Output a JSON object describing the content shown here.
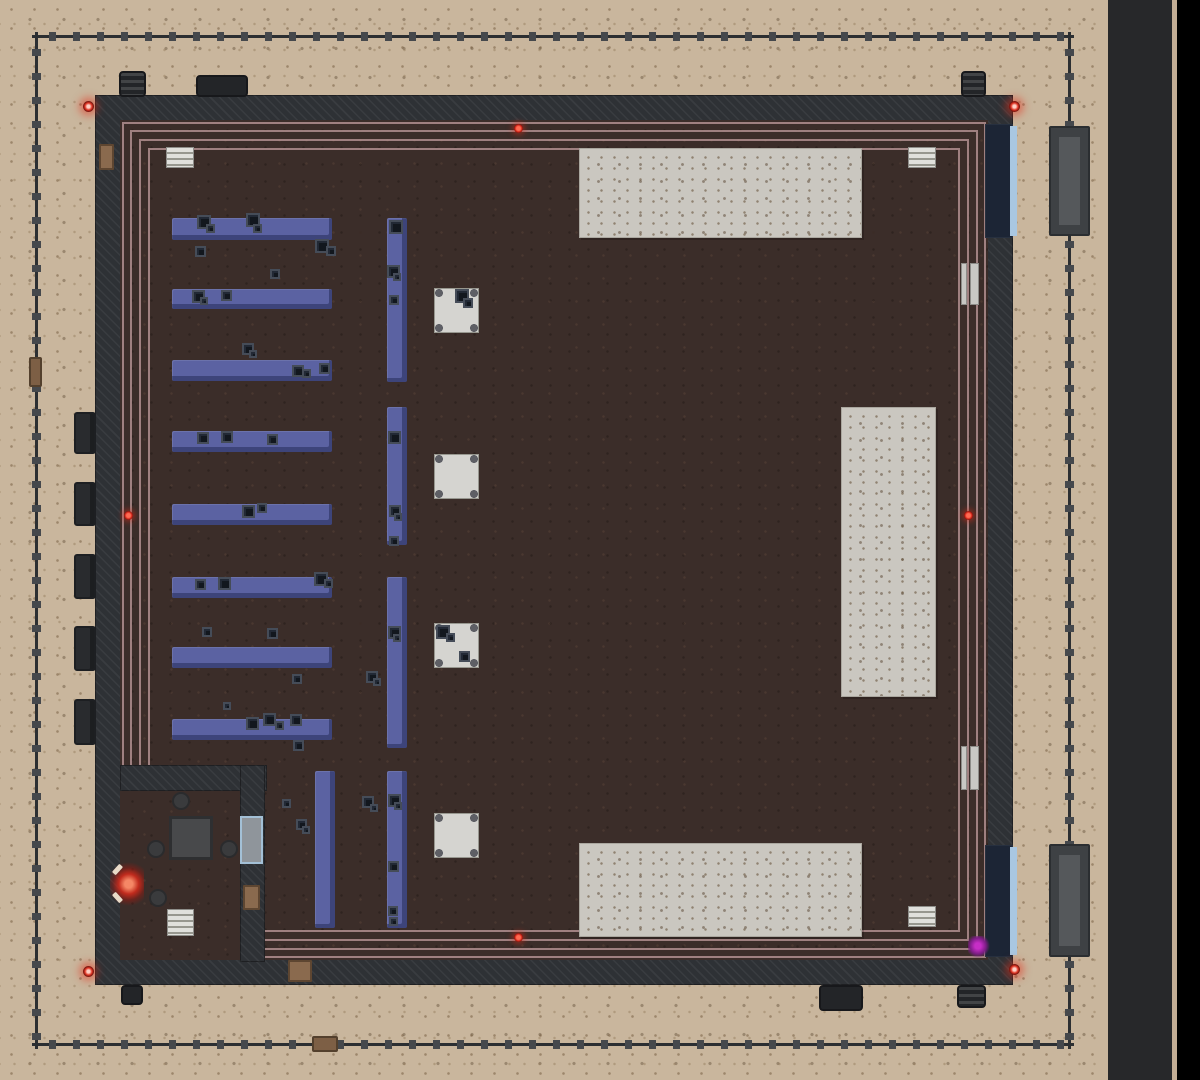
{
  "palette": {
    "sand": "#c9b69d",
    "road": "#27282a",
    "curb": "#c3ae95",
    "void": "#000000",
    "fence": "#2c2f32",
    "fence_post": "#45484c",
    "wall": "#2e3135",
    "floor": "#3b2d29",
    "trim": "#b18f8f",
    "pad": "#cac7c0",
    "shelf": "#5b62a2",
    "crate": "#12171e",
    "crate_outline": "#454c58",
    "table_white": "#d5d4d0",
    "gate_brown": "#7d5f45",
    "gate_gray": "#3e4144",
    "gate_gray_inner": "#55585b",
    "garage_navy": "#1c2535",
    "garage_blue": "#a9c7e1",
    "door_brown": "#8a6a4e",
    "window_frame": "#a3c0d6",
    "window_glass": "#8f959b",
    "radiator": "#c8c8c4",
    "unit_dark": "#232528",
    "room_table": "#48494b",
    "stool": "#3a3b3d",
    "sensor_red": "#e02418",
    "glow_purple": "#8b1d8b"
  },
  "layers": {
    "road": [
      [
        1108,
        0,
        64,
        1080
      ]
    ],
    "curb": [
      [
        1172,
        0,
        5,
        1080
      ]
    ],
    "void": [
      [
        1177,
        0,
        23,
        1080
      ]
    ],
    "fence_h": [
      [
        32,
        32,
        1042,
        9
      ],
      [
        32,
        1040,
        1042,
        9
      ]
    ],
    "fence_v": [
      [
        32,
        32,
        9,
        1017
      ],
      [
        1065,
        32,
        9,
        1017
      ]
    ],
    "gates_brown": [
      [
        29,
        357,
        13,
        30
      ],
      [
        312,
        1036,
        26,
        16
      ]
    ],
    "gates_gray": [
      [
        1049,
        126,
        41,
        110
      ],
      [
        1049,
        844,
        41,
        113
      ]
    ],
    "building_slab": [
      [
        95,
        95,
        918,
        890
      ]
    ],
    "building_floor": [
      [
        120,
        120,
        868,
        840
      ]
    ],
    "trim": [
      [
        122,
        122,
        864,
        836
      ],
      [
        130,
        130,
        848,
        820
      ],
      [
        139,
        139,
        830,
        802
      ],
      [
        148,
        148,
        812,
        784
      ]
    ],
    "room_walls": [
      [
        120,
        765,
        147,
        26
      ],
      [
        240,
        765,
        25,
        197
      ]
    ],
    "room_floor": [
      [
        120,
        791,
        120,
        169
      ]
    ],
    "pads": [
      [
        579,
        148,
        283,
        90
      ],
      [
        841,
        407,
        95,
        290
      ],
      [
        579,
        843,
        283,
        94
      ]
    ],
    "garage_doors": [
      [
        985,
        124,
        28,
        114
      ],
      [
        985,
        845,
        28,
        112
      ]
    ],
    "garage_strips": [
      [
        1010,
        126,
        7,
        110
      ],
      [
        1010,
        847,
        7,
        108
      ]
    ],
    "doors_brown": [
      [
        99,
        144,
        15,
        26
      ],
      [
        288,
        960,
        24,
        22
      ],
      [
        243,
        885,
        17,
        25
      ]
    ],
    "windows": [
      [
        240,
        816,
        23,
        48
      ]
    ],
    "radiators": [
      [
        961,
        263,
        6,
        42
      ],
      [
        970,
        263,
        9,
        42
      ],
      [
        961,
        746,
        6,
        44
      ],
      [
        970,
        746,
        9,
        44
      ]
    ],
    "shelves_h": [
      [
        172,
        218,
        160,
        22
      ],
      [
        172,
        289,
        160,
        20
      ],
      [
        172,
        360,
        160,
        21
      ],
      [
        172,
        431,
        160,
        21
      ],
      [
        172,
        504,
        160,
        21
      ],
      [
        172,
        577,
        160,
        21
      ],
      [
        172,
        647,
        160,
        21
      ],
      [
        172,
        719,
        160,
        21
      ]
    ],
    "shelves_v": [
      [
        387,
        218,
        20,
        164
      ],
      [
        387,
        407,
        20,
        138
      ],
      [
        387,
        577,
        20,
        171
      ],
      [
        387,
        771,
        20,
        157
      ],
      [
        315,
        771,
        20,
        157
      ]
    ],
    "tables_small": [
      [
        434,
        288,
        45,
        45
      ],
      [
        434,
        454,
        45,
        45
      ],
      [
        434,
        623,
        45,
        45
      ],
      [
        434,
        813,
        45,
        45
      ]
    ],
    "crates": [
      [
        197,
        215,
        14
      ],
      [
        206,
        224,
        9
      ],
      [
        246,
        213,
        14
      ],
      [
        253,
        224,
        9
      ],
      [
        195,
        246,
        11
      ],
      [
        315,
        239,
        14
      ],
      [
        326,
        246,
        10
      ],
      [
        270,
        269,
        10
      ],
      [
        192,
        290,
        13
      ],
      [
        200,
        297,
        8
      ],
      [
        221,
        290,
        11
      ],
      [
        242,
        343,
        12
      ],
      [
        249,
        350,
        8
      ],
      [
        292,
        365,
        12
      ],
      [
        302,
        369,
        9
      ],
      [
        319,
        363,
        11
      ],
      [
        197,
        432,
        12
      ],
      [
        221,
        431,
        12
      ],
      [
        267,
        434,
        11
      ],
      [
        242,
        505,
        13
      ],
      [
        257,
        503,
        10
      ],
      [
        195,
        579,
        11
      ],
      [
        218,
        577,
        13
      ],
      [
        314,
        572,
        14
      ],
      [
        324,
        579,
        9
      ],
      [
        202,
        627,
        10
      ],
      [
        267,
        628,
        11
      ],
      [
        292,
        674,
        10
      ],
      [
        223,
        702,
        8
      ],
      [
        246,
        717,
        13
      ],
      [
        263,
        713,
        13
      ],
      [
        275,
        721,
        9
      ],
      [
        290,
        714,
        12
      ],
      [
        293,
        740,
        11
      ],
      [
        389,
        220,
        14
      ],
      [
        387,
        265,
        13
      ],
      [
        393,
        273,
        8
      ],
      [
        389,
        295,
        10
      ],
      [
        388,
        431,
        13
      ],
      [
        389,
        505,
        12
      ],
      [
        394,
        513,
        8
      ],
      [
        389,
        536,
        10
      ],
      [
        388,
        626,
        13
      ],
      [
        393,
        634,
        8
      ],
      [
        366,
        671,
        12
      ],
      [
        373,
        678,
        8
      ],
      [
        388,
        794,
        13
      ],
      [
        394,
        802,
        8
      ],
      [
        388,
        861,
        11
      ],
      [
        388,
        906,
        10
      ],
      [
        389,
        917,
        9
      ],
      [
        296,
        819,
        11
      ],
      [
        302,
        826,
        8
      ],
      [
        362,
        796,
        12
      ],
      [
        370,
        804,
        8
      ],
      [
        282,
        799,
        9
      ],
      [
        455,
        289,
        14
      ],
      [
        463,
        298,
        10
      ],
      [
        436,
        625,
        14
      ],
      [
        446,
        633,
        9
      ],
      [
        459,
        651,
        11
      ]
    ],
    "vents": [
      [
        166,
        147,
        28,
        21
      ],
      [
        908,
        147,
        28,
        21
      ],
      [
        908,
        906,
        28,
        21
      ],
      [
        167,
        909,
        27,
        27
      ]
    ],
    "room_tables": [
      [
        169,
        816,
        44,
        44
      ]
    ],
    "stools": [
      [
        172,
        792,
        18
      ],
      [
        147,
        840,
        18
      ],
      [
        220,
        840,
        18
      ],
      [
        149,
        889,
        18
      ]
    ],
    "fires": [
      [
        110,
        862,
        34,
        44
      ]
    ],
    "sensors": [
      [
        514,
        124,
        9
      ],
      [
        124,
        511,
        9
      ],
      [
        964,
        511,
        9
      ],
      [
        514,
        933,
        9
      ]
    ],
    "corner_lights": [
      [
        83,
        101,
        11
      ],
      [
        1009,
        101,
        11
      ],
      [
        83,
        966,
        11
      ],
      [
        1009,
        964,
        11
      ]
    ],
    "purple_glows": [
      [
        968,
        936,
        22,
        22
      ]
    ],
    "units_striped": [
      [
        119,
        71,
        27,
        26
      ],
      [
        961,
        71,
        25,
        26
      ],
      [
        957,
        985,
        29,
        23
      ]
    ],
    "units_plain": [
      [
        196,
        75,
        52,
        22
      ],
      [
        121,
        985,
        22,
        20
      ],
      [
        819,
        985,
        44,
        26
      ]
    ],
    "wall_units": [
      [
        74,
        412,
        22,
        42
      ],
      [
        74,
        482,
        22,
        44
      ],
      [
        74,
        554,
        22,
        45
      ],
      [
        74,
        626,
        22,
        45
      ],
      [
        74,
        699,
        22,
        46
      ]
    ]
  }
}
